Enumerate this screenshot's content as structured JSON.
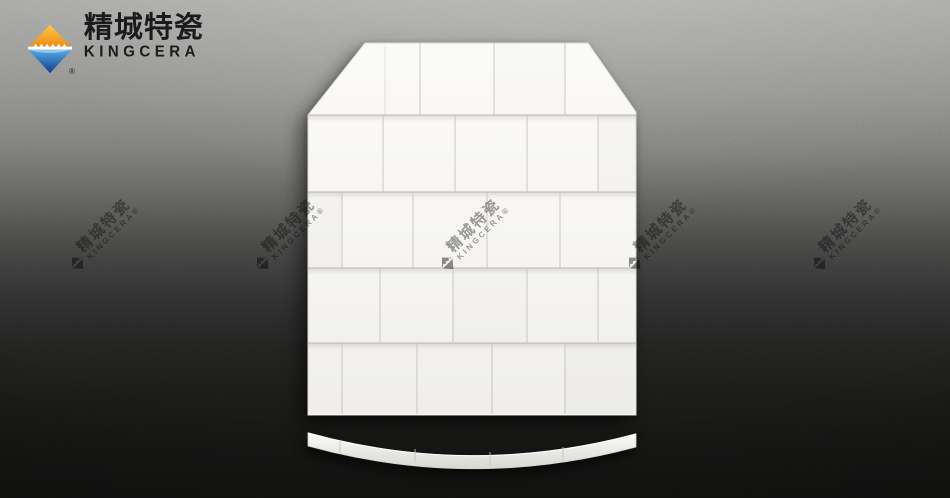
{
  "brand": {
    "logo_cn": "精城特瓷",
    "logo_en": "KINGCERA",
    "registered_mark": "®"
  },
  "watermark": {
    "text_cn": "精城特瓷",
    "text_en": "KINGCERA®",
    "count_visible": 5
  },
  "scene": {
    "subject": "White ceramic tiles assembled into a chamfered body-armor plate shape on a dark textured background, with a curved ceramic edge strip below",
    "plate_tile_rows": 5,
    "strip_segments": 5
  },
  "colors": {
    "background_top": "#a9a9a7",
    "background_bottom": "#121211",
    "tile_white": "#f7f6f3",
    "tile_joint": "#b9b7b1",
    "logo_orange": "#f49c1d",
    "logo_blue": "#1c57a5",
    "logo_text": "#1b1b1b",
    "watermark_gray": "#636363"
  }
}
